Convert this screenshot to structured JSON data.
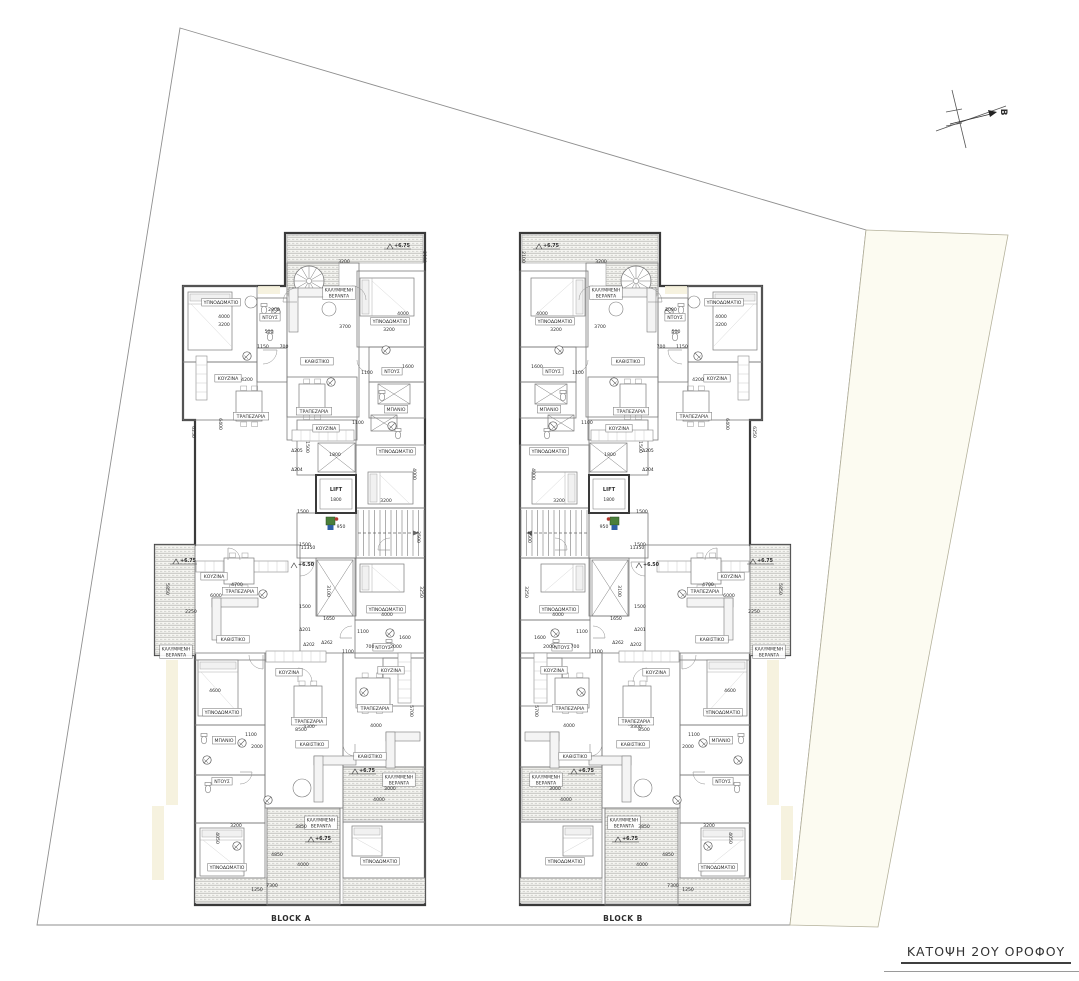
{
  "meta": {
    "title": "ΚΑΤΟΨΗ 2ΟΥ ΟΡΟΦΟΥ",
    "north_label": "Β",
    "drawing_type": "architectural floor plan, 2nd floor, two residential blocks"
  },
  "canvas": {
    "w": 1079,
    "h": 981,
    "bg": "#ffffff",
    "wall": "#3a3a3a",
    "line": "#7a7a7a",
    "text": "#2d2d2d",
    "hatch_bg": "#f6f6f2",
    "hatch_line": "#aeaeaa",
    "pale": "#f5f1dc",
    "icon_green": "#4a7f3b",
    "icon_blue": "#2f5fa5",
    "icon_red": "#b3392f"
  },
  "site": {
    "parcel": [
      [
        180,
        28
      ],
      [
        866,
        230
      ],
      [
        790,
        925
      ],
      [
        37,
        925
      ]
    ],
    "strip": [
      [
        866,
        230
      ],
      [
        1008,
        235
      ],
      [
        878,
        927
      ],
      [
        790,
        925
      ]
    ]
  },
  "north": {
    "x": 970,
    "y": 117,
    "label": "Β"
  },
  "mirror_sum": 945,
  "blocks": [
    {
      "label": "BLOCK A",
      "lx": 291,
      "ly": 921,
      "mirror": false
    },
    {
      "label": "BLOCK B",
      "lx": 623,
      "ly": 921,
      "mirror": true
    }
  ],
  "plan": {
    "envelope": [
      [
        285,
        233
      ],
      [
        425,
        233
      ],
      [
        425,
        905
      ],
      [
        195,
        905
      ],
      [
        195,
        655
      ],
      [
        155,
        655
      ],
      [
        155,
        545
      ],
      [
        195,
        545
      ],
      [
        195,
        420
      ],
      [
        183,
        420
      ],
      [
        183,
        286
      ],
      [
        285,
        286
      ]
    ],
    "hatches": [
      [
        287,
        235,
        136,
        28
      ],
      [
        287,
        263,
        52,
        32
      ],
      [
        155,
        545,
        40,
        110
      ],
      [
        343,
        767,
        80,
        53
      ],
      [
        267,
        808,
        73,
        95
      ],
      [
        195,
        878,
        72,
        25
      ],
      [
        343,
        878,
        82,
        25
      ]
    ],
    "pale": [
      [
        258,
        286,
        22,
        8
      ],
      [
        166,
        660,
        12,
        145
      ],
      [
        152,
        806,
        12,
        74
      ]
    ],
    "rooms": [
      [
        183,
        286,
        74,
        76
      ],
      [
        257,
        298,
        30,
        50
      ],
      [
        257,
        348,
        30,
        34
      ],
      [
        287,
        263,
        72,
        154
      ],
      [
        357,
        271,
        68,
        76
      ],
      [
        369,
        347,
        56,
        35
      ],
      [
        369,
        382,
        56,
        36
      ],
      [
        183,
        362,
        74,
        58
      ],
      [
        287,
        377,
        70,
        63
      ],
      [
        297,
        420,
        59,
        55
      ],
      [
        356,
        445,
        69,
        63
      ],
      [
        297,
        513,
        59,
        45
      ],
      [
        356,
        508,
        69,
        50
      ],
      [
        316,
        558,
        40,
        58
      ],
      [
        355,
        558,
        70,
        62
      ],
      [
        355,
        620,
        70,
        38
      ],
      [
        383,
        658,
        42,
        48
      ],
      [
        195,
        545,
        105,
        115
      ],
      [
        195,
        653,
        70,
        72
      ],
      [
        195,
        725,
        70,
        50
      ],
      [
        195,
        775,
        70,
        48
      ],
      [
        195,
        823,
        70,
        55
      ],
      [
        265,
        653,
        78,
        155
      ],
      [
        343,
        653,
        82,
        114
      ],
      [
        343,
        767,
        82,
        55
      ],
      [
        343,
        822,
        82,
        56
      ],
      [
        267,
        808,
        73,
        97
      ]
    ],
    "lift": {
      "box": [
        316,
        475,
        40,
        38
      ],
      "label": "LIFT",
      "label_pos": [
        336,
        491
      ],
      "dim": "1800",
      "dim_pos": [
        336,
        501
      ]
    },
    "stairs": {
      "x1": 358,
      "x2": 424,
      "y1": 510,
      "y2": 556,
      "step": 5.5,
      "arrow_y": 533
    },
    "spiral": [
      309,
      281,
      15
    ],
    "icon": [
      326,
      517
    ],
    "xboxes": [
      [
        318,
        443,
        37,
        29
      ],
      [
        317,
        560,
        36,
        56
      ],
      [
        378,
        384,
        32,
        20
      ],
      [
        371,
        415,
        26,
        16
      ]
    ],
    "beds": [
      [
        188,
        292,
        44,
        58
      ],
      [
        360,
        278,
        54,
        38
      ],
      [
        368,
        472,
        45,
        32
      ],
      [
        360,
        564,
        44,
        28
      ],
      [
        198,
        660,
        40,
        56
      ],
      [
        200,
        828,
        44,
        48
      ],
      [
        352,
        826,
        30,
        30
      ]
    ],
    "tables": [
      [
        236,
        391,
        26,
        30
      ],
      [
        299,
        384,
        26,
        30
      ],
      [
        224,
        558,
        30,
        26
      ],
      [
        294,
        686,
        28,
        34
      ],
      [
        356,
        678,
        34,
        30
      ]
    ],
    "sofas": [
      [
        289,
        288,
        40,
        44
      ],
      [
        212,
        598,
        46,
        42
      ],
      [
        314,
        756,
        42,
        46
      ],
      [
        386,
        732,
        34,
        36
      ]
    ],
    "rounds": [
      [
        329,
        309,
        7
      ],
      [
        302,
        788,
        9
      ],
      [
        251,
        302,
        6
      ]
    ],
    "counters": [
      [
        196,
        561,
        92,
        11
      ],
      [
        266,
        651,
        60,
        11
      ],
      [
        398,
        653,
        13,
        50
      ],
      [
        292,
        430,
        62,
        11
      ],
      [
        196,
        356,
        11,
        44
      ]
    ],
    "wcs": [
      [
        264,
        307
      ],
      [
        270,
        334
      ],
      [
        382,
        394
      ],
      [
        204,
        737
      ],
      [
        208,
        786
      ],
      [
        389,
        643
      ],
      [
        398,
        432
      ]
    ],
    "arcs": [
      [
        263,
        350,
        14,
        0
      ],
      [
        297,
        302,
        14,
        2
      ],
      [
        352,
        300,
        14,
        3
      ],
      [
        369,
        360,
        12,
        1
      ],
      [
        300,
        562,
        14,
        0
      ],
      [
        352,
        638,
        12,
        2
      ],
      [
        263,
        655,
        14,
        1
      ],
      [
        298,
        682,
        14,
        3
      ],
      [
        240,
        772,
        12,
        0
      ],
      [
        355,
        744,
        12,
        1
      ],
      [
        390,
        550,
        12,
        2
      ],
      [
        228,
        560,
        12,
        3
      ]
    ],
    "detail_marks": [
      [
        247,
        356
      ],
      [
        386,
        350
      ],
      [
        276,
        312
      ],
      [
        331,
        382
      ],
      [
        392,
        426
      ],
      [
        263,
        594
      ],
      [
        390,
        633
      ],
      [
        242,
        743
      ],
      [
        268,
        800
      ],
      [
        237,
        846
      ],
      [
        207,
        760
      ],
      [
        364,
        692
      ]
    ],
    "labels": [
      [
        "ΥΠΝΟΔΩΜΑΤΙΟ",
        221,
        303
      ],
      [
        "ΥΠΝΟΔΩΜΑΤΙΟ",
        390,
        322
      ],
      [
        "ΥΠΝΟΔΩΜΑΤΙΟ",
        396,
        452
      ],
      [
        "ΥΠΝΟΔΩΜΑΤΙΟ",
        386,
        610
      ],
      [
        "ΥΠΝΟΔΩΜΑΤΙΟ",
        222,
        713
      ],
      [
        "ΥΠΝΟΔΩΜΑΤΙΟ",
        227,
        868
      ],
      [
        "ΥΠΝΟΔΩΜΑΤΙΟ",
        380,
        862
      ],
      [
        "ΚΑΘΙΣΤΙΚΟ",
        317,
        362
      ],
      [
        "ΚΑΘΙΣΤΙΚΟ",
        233,
        640
      ],
      [
        "ΚΑΘΙΣΤΙΚΟ",
        312,
        745
      ],
      [
        "ΚΑΘΙΣΤΙΚΟ",
        370,
        757
      ],
      [
        "ΤΡΑΠΕΖΑΡΙΑ",
        251,
        417
      ],
      [
        "ΤΡΑΠΕΖΑΡΙΑ",
        314,
        412
      ],
      [
        "ΤΡΑΠΕΖΑΡΙΑ",
        240,
        592
      ],
      [
        "ΤΡΑΠΕΖΑΡΙΑ",
        309,
        722
      ],
      [
        "ΤΡΑΠΕΖΑΡΙΑ",
        375,
        709
      ],
      [
        "ΚΟΥΖΙΝΑ",
        228,
        379
      ],
      [
        "ΚΟΥΖΙΝΑ",
        326,
        429
      ],
      [
        "ΚΟΥΖΙΝΑ",
        214,
        577
      ],
      [
        "ΚΟΥΖΙΝΑ",
        289,
        673
      ],
      [
        "ΚΟΥΖΙΝΑ",
        391,
        671
      ],
      [
        "ΝΤΟΥΣ",
        270,
        318
      ],
      [
        "ΝΤΟΥΣ",
        392,
        372
      ],
      [
        "ΝΤΟΥΣ",
        383,
        648
      ],
      [
        "ΝΤΟΥΣ",
        222,
        782
      ],
      [
        "ΜΠΑΝΙΟ",
        396,
        410
      ],
      [
        "ΜΠΑΝΙΟ",
        224,
        741
      ]
    ],
    "veranda_label": [
      "ΚΑΛΥΜΜΕΝΗ",
      "ΒΕΡΑΝΤΑ"
    ],
    "veranda_label_pos": [
      [
        339,
        291
      ],
      [
        176,
        650
      ],
      [
        399,
        778
      ],
      [
        321,
        821
      ]
    ],
    "levels": {
      "text": "+6.75",
      "pos": [
        [
          398,
          247
        ],
        [
          184,
          562
        ],
        [
          363,
          772
        ],
        [
          319,
          840
        ]
      ],
      "mid_text": "+6.50",
      "mid_pos": [
        300,
        566
      ]
    },
    "deltas": [
      [
        "Δ205",
        297,
        452
      ],
      [
        "Δ204",
        297,
        471
      ],
      [
        "Δ201",
        305,
        631
      ],
      [
        "Δ202",
        309,
        646
      ],
      [
        "Δ262",
        327,
        644
      ]
    ],
    "dims": [
      [
        "2100",
        423,
        257,
        90
      ],
      [
        "3200",
        344,
        263,
        0
      ],
      [
        "4000",
        224,
        318,
        0
      ],
      [
        "3200",
        224,
        326,
        0
      ],
      [
        "2000",
        274,
        311,
        0
      ],
      [
        "500",
        269,
        333,
        0
      ],
      [
        "1150",
        263,
        348,
        0
      ],
      [
        "700",
        284,
        348,
        0
      ],
      [
        "3700",
        345,
        328,
        0
      ],
      [
        "4000",
        403,
        315,
        0
      ],
      [
        "3200",
        389,
        331,
        0
      ],
      [
        "1100",
        367,
        374,
        0
      ],
      [
        "1600",
        408,
        368,
        0
      ],
      [
        "4200",
        247,
        381,
        0
      ],
      [
        "1100",
        358,
        424,
        0
      ],
      [
        "6400",
        219,
        424,
        90
      ],
      [
        "6250",
        192,
        432,
        90
      ],
      [
        "1500",
        306,
        447,
        90
      ],
      [
        "1800",
        335,
        456,
        0
      ],
      [
        "4000",
        413,
        474,
        90
      ],
      [
        "3200",
        386,
        502,
        0
      ],
      [
        "1500",
        303,
        513,
        0
      ],
      [
        "950",
        341,
        528,
        0
      ],
      [
        "2500",
        417,
        537,
        90
      ],
      [
        "11350",
        308,
        549,
        0
      ],
      [
        "1500",
        305,
        546,
        0
      ],
      [
        "3100",
        327,
        591,
        90
      ],
      [
        "1500",
        305,
        608,
        0
      ],
      [
        "1650",
        329,
        620,
        0
      ],
      [
        "5850",
        166,
        589,
        90
      ],
      [
        "2250",
        191,
        613,
        0
      ],
      [
        "4700",
        237,
        586,
        0
      ],
      [
        "6000",
        216,
        597,
        0
      ],
      [
        "3250",
        420,
        592,
        90
      ],
      [
        "4000",
        387,
        616,
        0
      ],
      [
        "1100",
        363,
        633,
        0
      ],
      [
        "700",
        370,
        648,
        0
      ],
      [
        "2000",
        396,
        648,
        0
      ],
      [
        "1600",
        405,
        639,
        0
      ],
      [
        "1100",
        348,
        653,
        0
      ],
      [
        "4600",
        215,
        692,
        0
      ],
      [
        "1100",
        251,
        736,
        0
      ],
      [
        "2000",
        257,
        748,
        0
      ],
      [
        "8500",
        301,
        731,
        0
      ],
      [
        "3300",
        309,
        728,
        0
      ],
      [
        "4000",
        376,
        727,
        0
      ],
      [
        "5700",
        410,
        711,
        90
      ],
      [
        "3000",
        390,
        790,
        0
      ],
      [
        "4000",
        379,
        801,
        0
      ],
      [
        "3200",
        236,
        827,
        0
      ],
      [
        "4050",
        216,
        838,
        90
      ],
      [
        "3850",
        301,
        828,
        0
      ],
      [
        "4850",
        277,
        856,
        0
      ],
      [
        "4000",
        303,
        866,
        0
      ],
      [
        "7300",
        272,
        887,
        0
      ],
      [
        "1250",
        257,
        891,
        0
      ]
    ]
  }
}
